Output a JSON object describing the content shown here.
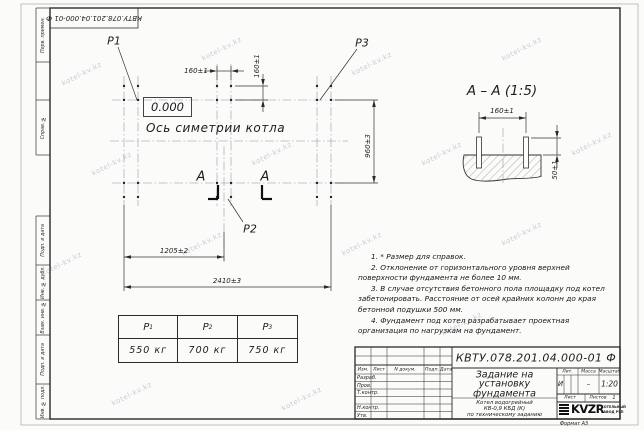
{
  "watermark": "kotel-kv.kz",
  "margin": {
    "top_stamp": "КВТУ.078.201.04.000-01  Ф",
    "labels": [
      "Перв. примен.",
      "Справ. №",
      "Подп. и дата",
      "Инв. № дубл.",
      "Взам. инв. №",
      "Подп. и дата",
      "Инв. № подл."
    ]
  },
  "plan": {
    "load_labels": {
      "p1": "Р1",
      "p2": "Р2",
      "p3": "Р3"
    },
    "level_mark": "0.000",
    "axis_label": "Ось симетрии котла",
    "dim_bolt_x": "160±1",
    "dim_bolt_y": "160±1",
    "dim_rows": "960±3",
    "dim_half": "1205±2",
    "dim_full": "2410±3",
    "section_letter_left": "А",
    "section_letter_right": "А"
  },
  "section_view": {
    "title": "А – А (1:5)",
    "dim_bolts": "160±1",
    "dim_height": "50±1"
  },
  "notes": [
    {
      "num": "1.",
      "text": "* Размер для справок."
    },
    {
      "num": "2.",
      "text": "Отклонение от горизонтального уровня верхней поверхности фундамента не более 10 мм."
    },
    {
      "num": "3.",
      "text": "В случае отсутствия бетонного пола площадку под котел забетонировать. Расстояние от осей крайних колонн до края бетонной подушки 500 мм."
    },
    {
      "num": "4.",
      "text": "Фундамент под котел разрабатывает проектная организация по нагрузкам на фундамент."
    }
  ],
  "load_table": {
    "headers": [
      {
        "sym": "Р",
        "sub": "1"
      },
      {
        "sym": "Р",
        "sub": "2"
      },
      {
        "sym": "Р",
        "sub": "3"
      }
    ],
    "values": [
      "550 кг",
      "700 кг",
      "750 кг"
    ]
  },
  "title_block": {
    "doc_number": "КВТУ.078.201.04.000-01 Ф",
    "columns": {
      "izm": "Изм.",
      "list": "Лист",
      "doc": "N докум.",
      "sign": "Подп.",
      "date": "Дата"
    },
    "rows": {
      "developed": "Разраб.",
      "checked": "Пров.",
      "tcontrol": "Т.контр.",
      "ncontrol": "Н.контр.",
      "approved": "Утв."
    },
    "title_lines": [
      "Задание на",
      "установку",
      "фундамента"
    ],
    "subtitle_lines": [
      "Котел водогрейный",
      "КВ-0,9 КБД (К)",
      "по техническому заданию"
    ],
    "lit_header": "Лит.",
    "mass_header": "Масса",
    "scale_header": "Масштаб",
    "lit_value": "И",
    "mass_value": "–",
    "scale_value": "1:20",
    "sheet_label": "Лист",
    "sheets_label": "Листов",
    "sheets_value": "1",
    "company": {
      "name": "KVZR",
      "desc_lines": [
        "КОТЕЛЬНЫЙ",
        "ЗАВОД РЭП"
      ]
    },
    "format": "Формат А3"
  }
}
